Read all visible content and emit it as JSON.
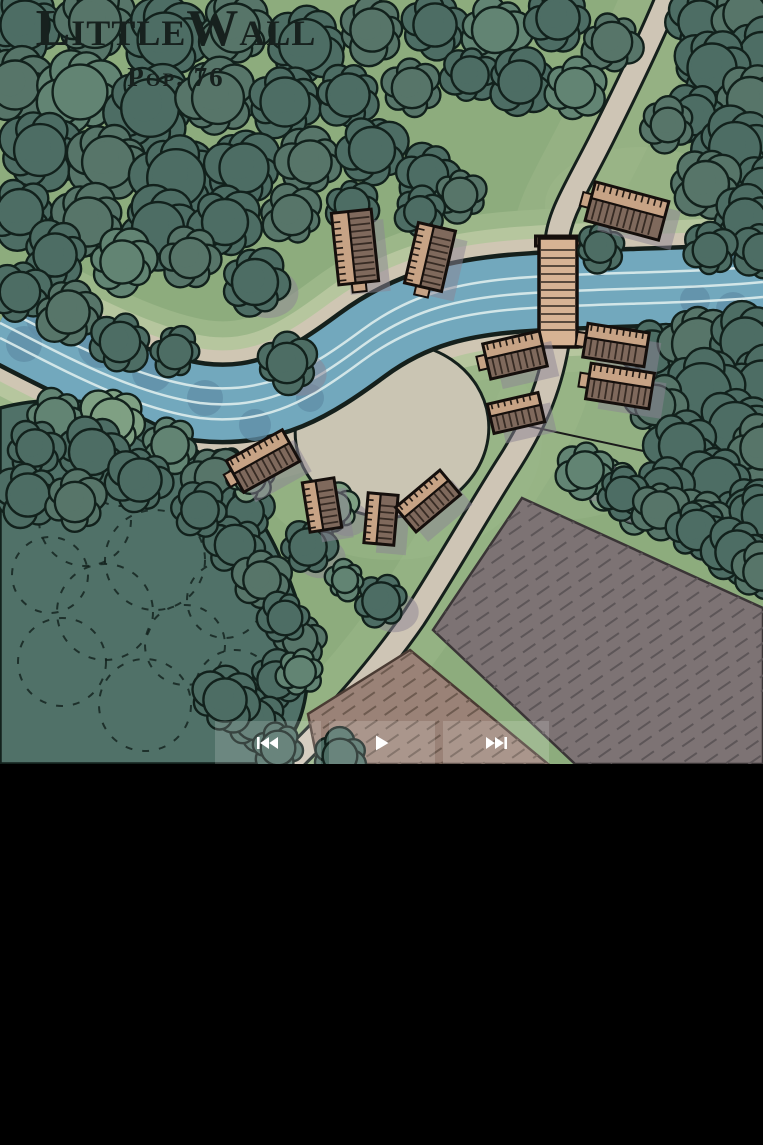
{
  "map": {
    "title": "LittleWall",
    "population_label": "Pop. 76",
    "features": [
      "forest",
      "river",
      "bridge",
      "roads",
      "village-houses",
      "central-plaza",
      "farm-fields"
    ]
  },
  "controls": {
    "buttons": [
      {
        "id": "skip-start",
        "icon": "skip-start-icon"
      },
      {
        "id": "play",
        "icon": "play-icon"
      },
      {
        "id": "skip-end",
        "icon": "skip-end-icon"
      }
    ]
  },
  "palette": {
    "grass": "#8dac7d",
    "grass_light": "#9cb789",
    "grass_pale": "#b6c69e",
    "sand": "#cfc6b3",
    "water": "#72a8bd",
    "water_shadow": "#608ea7",
    "wave": "#ddecec",
    "outline": "#15201c",
    "road": "#cec5b5",
    "plaza": "#cac5b3",
    "bridge": "#d7b394",
    "tree_dark": "#4d6d64",
    "tree_dark2": "#577569",
    "tree_med": "#628473",
    "tree_light": "#7fa083",
    "tree_light2": "#90ad8b",
    "forest_mass": "#507168",
    "tree_outline": "#12211c",
    "house_wall": "#7f695c",
    "house_roof": "#c7a385",
    "house_outline": "#150f0c",
    "field_gray": "#7d7374",
    "field_gray_line": "#5d5658",
    "field_brown": "#9a8277",
    "field_brown_line": "#6e5b50",
    "shadow": "#8b8393",
    "title_color": "#17211e",
    "button_bg": "rgba(255,255,255,0.16)",
    "button_icon": "#ffffff"
  }
}
